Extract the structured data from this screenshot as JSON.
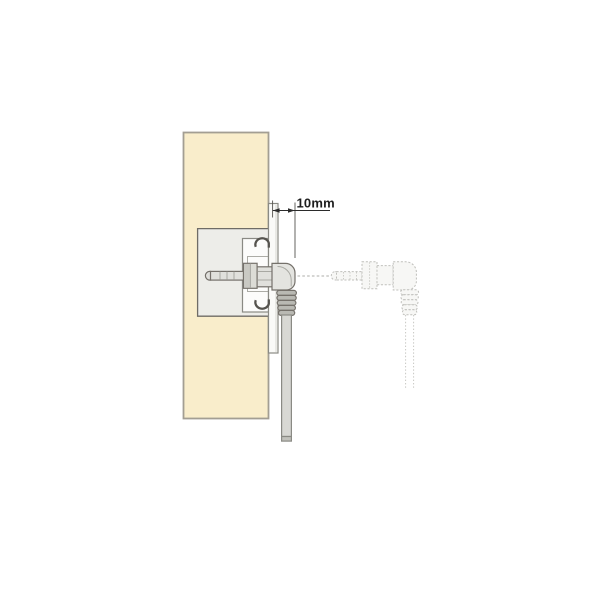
{
  "diagram": {
    "dimension_label": "10mm",
    "parts": [
      "wall-panel",
      "panel-recess",
      "mounting-flange",
      "bracket-housing",
      "keyhole-hook-top",
      "keyhole-hook-bottom",
      "jack-plug",
      "collar-nut",
      "elbow-connector",
      "strain-relief",
      "cable",
      "dimension-annotation",
      "insertion-axis",
      "ghost-connector",
      "ghost-cable"
    ],
    "colors": {
      "background": "#FFFFFF",
      "panel_fill": "#F9EDCB",
      "panel_border": "#A39E93",
      "recess_fill": "#EDEDE9",
      "housing_fill": "#FCFCFB",
      "flange_fill": "#FAFAF8",
      "metal_light": "#E0E0DC",
      "metal_dark": "#C9C9C3",
      "collar_fill": "#DCDCD6",
      "elbow_fill": "#E4E4E0",
      "rib_fill": "#B9B9B3",
      "cable_fill": "#D8D8D4",
      "cable_cap": "#C2C2BC",
      "ghost_fill": "#F7F7F5",
      "ghost_stroke": "#C0C0BC",
      "dimension_color": "#1E1E1E"
    }
  }
}
